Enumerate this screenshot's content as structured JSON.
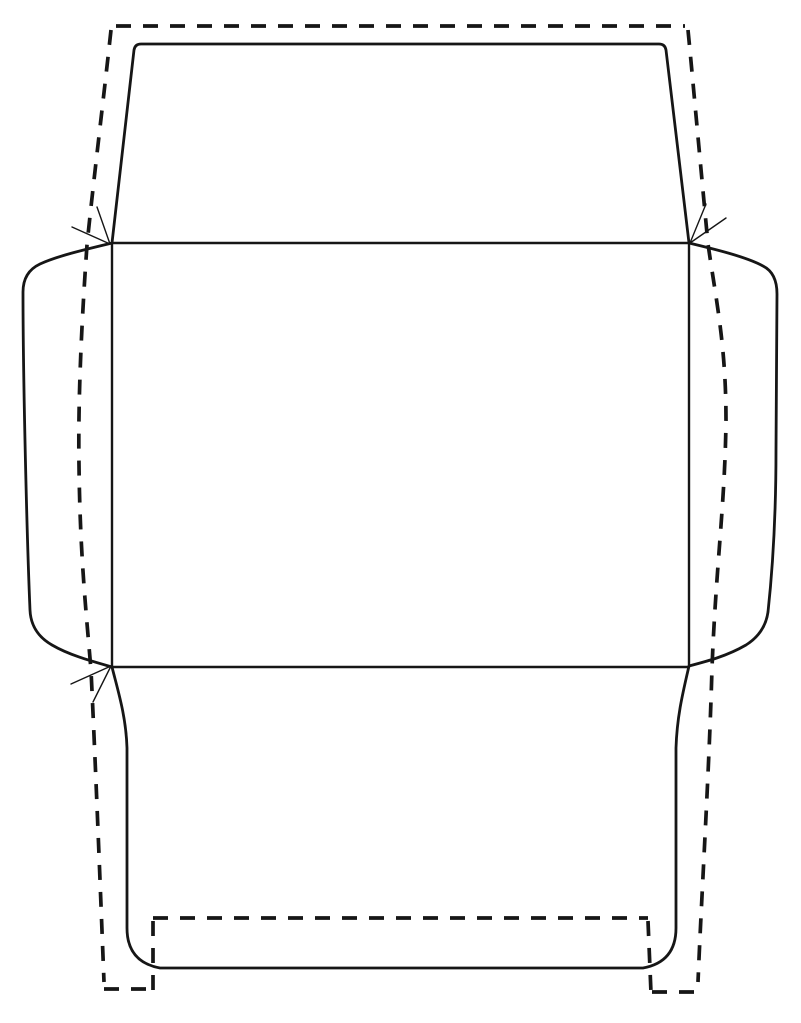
{
  "canvas": {
    "width": 801,
    "height": 1023,
    "background": "#ffffff"
  },
  "styles": {
    "line_color": "#161616",
    "cut_line_width": 2.8,
    "fold_line_width": 2.4,
    "dashed_line_width": 3.7,
    "dash_pattern": "15 12",
    "arrow_line_width": 1.4
  },
  "shapes": [
    {
      "name": "template-cut-outline",
      "kind": "cut",
      "d": "M 112 243 L 134 50 Q 135 44 141 44 L 659 44 Q 665 44 666 50 L 689 243 C 714 249 747 257 763 266 Q 777 273 777 294 L 776 450 C 776 520 772 575 768 612 Q 765 633 746 645 C 727 656 708 661 689 666 C 683 692 677 716 676 748 L 676 928 Q 676 962 643 968 L 160 968 Q 127 962 127 928 L 127 748 C 126 716 118 691 112 667 C 91 661 69 655 52 645 Q 31 633 30 610 C 27 540 23 380 23 292 Q 23 272 40 264 C 57 256 87 249 112 243 Z"
    },
    {
      "name": "fold-lines",
      "kind": "fold",
      "d": "M 112 243 H 689 M 112 667 H 689 M 112 243 V 667 M 689 243 V 667"
    },
    {
      "name": "finished-envelope-dashed-outline",
      "kind": "dashed",
      "d": "M 116 26 H 685 M 111 30 C 104 95 93 185 87 245 C 81 330 78 405 79 465 C 80 555 86 610 91 670 C 96 775 100 880 104 982 M 104 989 H 152 M 688 30 C 691 60 700 160 708 244 C 716 300 726 345 726 420 C 725 505 716 565 712 668 C 709 775 702 885 698 982 M 652 992 H 697"
    },
    {
      "name": "bottom-band-dashed-outline",
      "kind": "dashed",
      "d": "M 153 918 H 648 M 153 921 V 993 M 648 921 L 651 993"
    },
    {
      "name": "fold-mark-arrow-top-left",
      "kind": "arrow",
      "d": "M 72 227 L 110 244 M 97 207 L 110 244"
    },
    {
      "name": "fold-mark-arrow-top-right",
      "kind": "arrow",
      "d": "M 726 218 L 690 243 M 706 204 L 690 243"
    },
    {
      "name": "fold-mark-arrow-bottom-left",
      "kind": "arrow",
      "d": "M 71 684 L 111 666 M 93 702 L 111 666"
    }
  ]
}
